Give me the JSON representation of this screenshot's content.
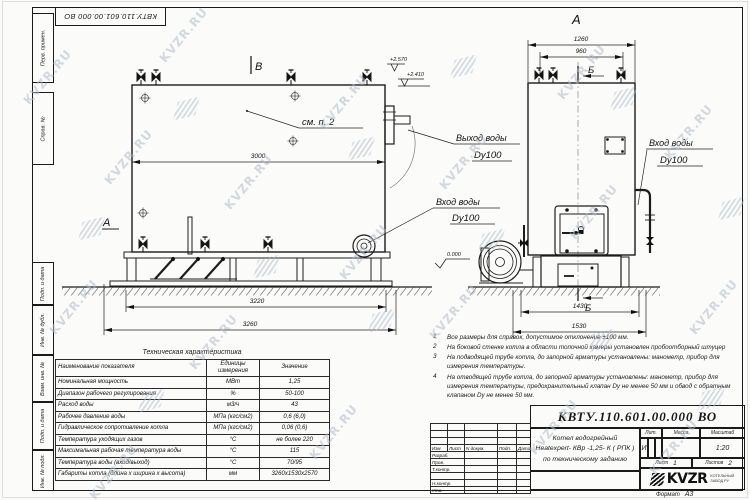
{
  "sheet": {
    "side_labels": [
      "Перв. примен.",
      "Справ. №",
      "Подп. и дата",
      "Инв. № дубл.",
      "Взам. инв. №",
      "Подп. и дата",
      "Инв. № подл."
    ],
    "format_label": "Формат",
    "format_value": "А3"
  },
  "watermark": {
    "text": "KVZR.RU"
  },
  "views": {
    "left": {
      "section_a": "А",
      "section_b": "В",
      "see_note": "см. п. 2",
      "dim_width": "3000",
      "dim_base": "3220",
      "dim_total": "3260",
      "elev_top": "+2.570",
      "elev_outlet": "+2.410",
      "elev_zero": "0.000",
      "inlet_line1": "Вход воды",
      "inlet_line2": "Dy100"
    },
    "right": {
      "section_a": "А",
      "marker_b_top": "Б",
      "marker_b_bottom": "Б",
      "dim_top_outer": "1260",
      "dim_top_inner": "960",
      "dim_base": "1430",
      "dim_total": "1530",
      "outlet_line1": "Выход воды",
      "outlet_line2": "Dy100",
      "inlet_line1": "Вход воды",
      "inlet_line2": "Dy100"
    }
  },
  "notes": [
    {
      "num": "1",
      "text": "Все размеры для справок, допустимое отклонение ±100 мм."
    },
    {
      "num": "2",
      "text": "На боковой стенке котла в области топочной камеры установлен пробоотборный штуцер"
    },
    {
      "num": "3",
      "text": "На подводящей трубе котла, до запорной арматуры установлены: манометр, прибор для измерения температуры."
    },
    {
      "num": "4",
      "text": "На отводящей трубе котла, до запорной арматуры установлены: манометр, прибор для измерения температуры, предохранительный клапан Dу не менее 50 мм и обвод с обратным клапаном Dу не менее 50 мм."
    }
  ],
  "tech_table": {
    "title": "Техническая характеристика",
    "headers": [
      "Наименование показателя",
      "Единицы измерения",
      "Значение"
    ],
    "rows": [
      [
        "Номинальная мощность",
        "МВт",
        "1,25"
      ],
      [
        "Диапазон рабочего регулирования",
        "%",
        "50-100"
      ],
      [
        "Расход воды",
        "м3/ч",
        "43"
      ],
      [
        "Рабочее давление воды",
        "МПа (кгс/см2)",
        "0,6 (6,0)"
      ],
      [
        "Гидравлическое сопротивление котла",
        "МПа (кгс/см2)",
        "0,06 (0,6)"
      ],
      [
        "Температура уходящих газов",
        "°С",
        "не более 220"
      ],
      [
        "Максимальная рабочая температура воды",
        "°С",
        "115"
      ],
      [
        "Температура воды (вход/выход)",
        "°С",
        "70/95"
      ],
      [
        "Габариты котла (длина х ширина х высота)",
        "мм",
        "3260х1530х2570"
      ]
    ]
  },
  "title_block": {
    "designation": "КВТУ.110.601.00.000  ВО",
    "name_line1": "Котел водогрейный",
    "name_line2": "Heatexpert- КВр -1,25- К ( РПК )",
    "name_line3": "по техническому заданию",
    "rev_headers": [
      "Изм",
      "Лист",
      "N докум.",
      "Подп.",
      "Дата"
    ],
    "sign_labels": [
      "Разраб.",
      "Пров.",
      "Т.контр.",
      "",
      "Н.контр.",
      "Утв."
    ],
    "lit_label": "Лит.",
    "mass_label": "Масса",
    "scale_label": "Масштаб",
    "lit_value": "И",
    "scale_value": "1:20",
    "sheet_label": "Лист",
    "sheet_number": "1",
    "sheets_label": "Листов",
    "sheets_total": "2",
    "brand": "KVZR",
    "brand_sub1": "КОТЕЛЬНЫЙ",
    "brand_sub2": "ЗАВОД РУ"
  }
}
